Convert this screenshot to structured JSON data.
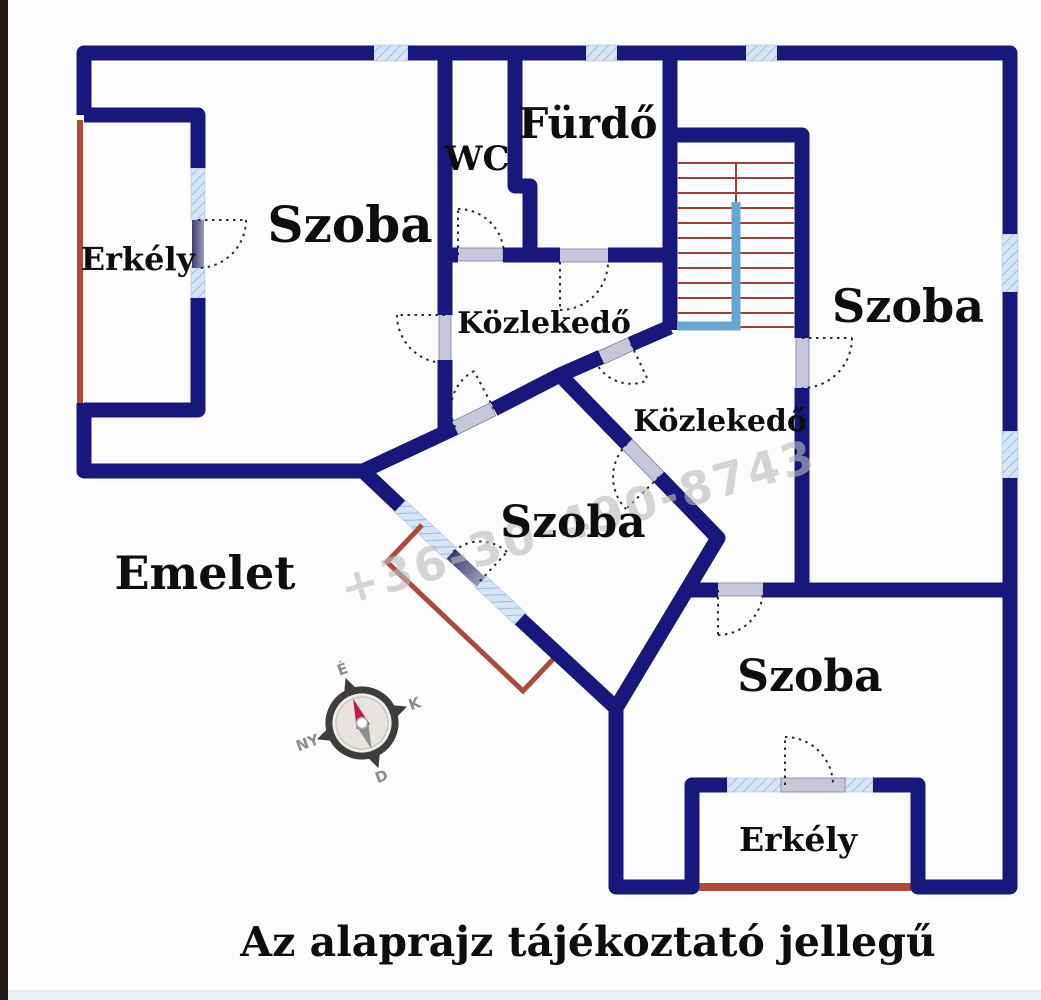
{
  "plan": {
    "floor_label": "Emelet",
    "caption": "Az alaprajz tájékoztató jellegű",
    "watermark": "+36-30-490-8743",
    "rooms": [
      {
        "id": "szoba-top-left",
        "label": "Szoba"
      },
      {
        "id": "erkely-left",
        "label": "Erkély"
      },
      {
        "id": "wc",
        "label": "WC"
      },
      {
        "id": "furdo",
        "label": "Fürdő"
      },
      {
        "id": "szoba-right",
        "label": "Szoba"
      },
      {
        "id": "kozlekedo-upper",
        "label": "Közlekedő"
      },
      {
        "id": "kozlekedo-lower",
        "label": "Közlekedő"
      },
      {
        "id": "szoba-middle",
        "label": "Szoba"
      },
      {
        "id": "szoba-bottom",
        "label": "Szoba"
      },
      {
        "id": "erkely-bottom",
        "label": "Erkély"
      }
    ],
    "compass": {
      "north": "É",
      "east": "K",
      "south": "D",
      "west": "NY"
    },
    "colors": {
      "wall": "#17177c",
      "window_fill": "#d6e6f6",
      "window_hatch": "#9cbede",
      "balcony_red": "#ad4a3c",
      "stair_step_red": "#9e4038",
      "stair_rail_blue": "#66a7d4",
      "door_sill": "#c7c7dc",
      "watermark_gray": "#bdbdbd"
    }
  }
}
